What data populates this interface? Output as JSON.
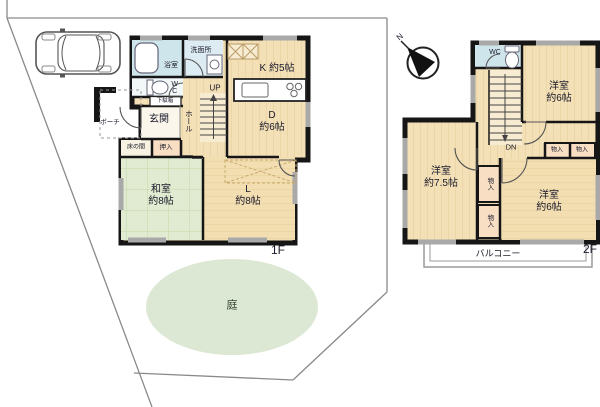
{
  "site": {
    "garden_label": "庭",
    "north_label": "N"
  },
  "floor1": {
    "floor_label": "1F",
    "bath": "浴室",
    "washroom": "洗面所",
    "wc": "WC",
    "shoe_cabinet": "下駄箱",
    "entrance": "玄関",
    "hall": "ホール",
    "stairs_up": "UP",
    "kitchen": "K 約5帖",
    "dining": "D\n約6帖",
    "living": "L\n約8帖",
    "washitsu": "和室\n約8帖",
    "closet": "押入",
    "tokonoma": "床の間",
    "porch": "ポーチ"
  },
  "floor2": {
    "floor_label": "2F",
    "wc": "WC",
    "stairs_down": "DN",
    "bedroom_north": "洋室\n約6帖",
    "bedroom_west": "洋室\n約7.5帖",
    "bedroom_south": "洋室\n約6帖",
    "storage": "物入",
    "balcony": "バルコニー"
  },
  "colors": {
    "wood": "#f3e0b6",
    "wood_line": "#e2cb96",
    "tatami": "#e1ebd1",
    "water": "#cfe5ec",
    "closet_fill": "#f8dfc4",
    "garden": "#dce8d3",
    "wall": "#161616",
    "window": "#a9a9a9",
    "boundary": "#8a8a8a"
  }
}
